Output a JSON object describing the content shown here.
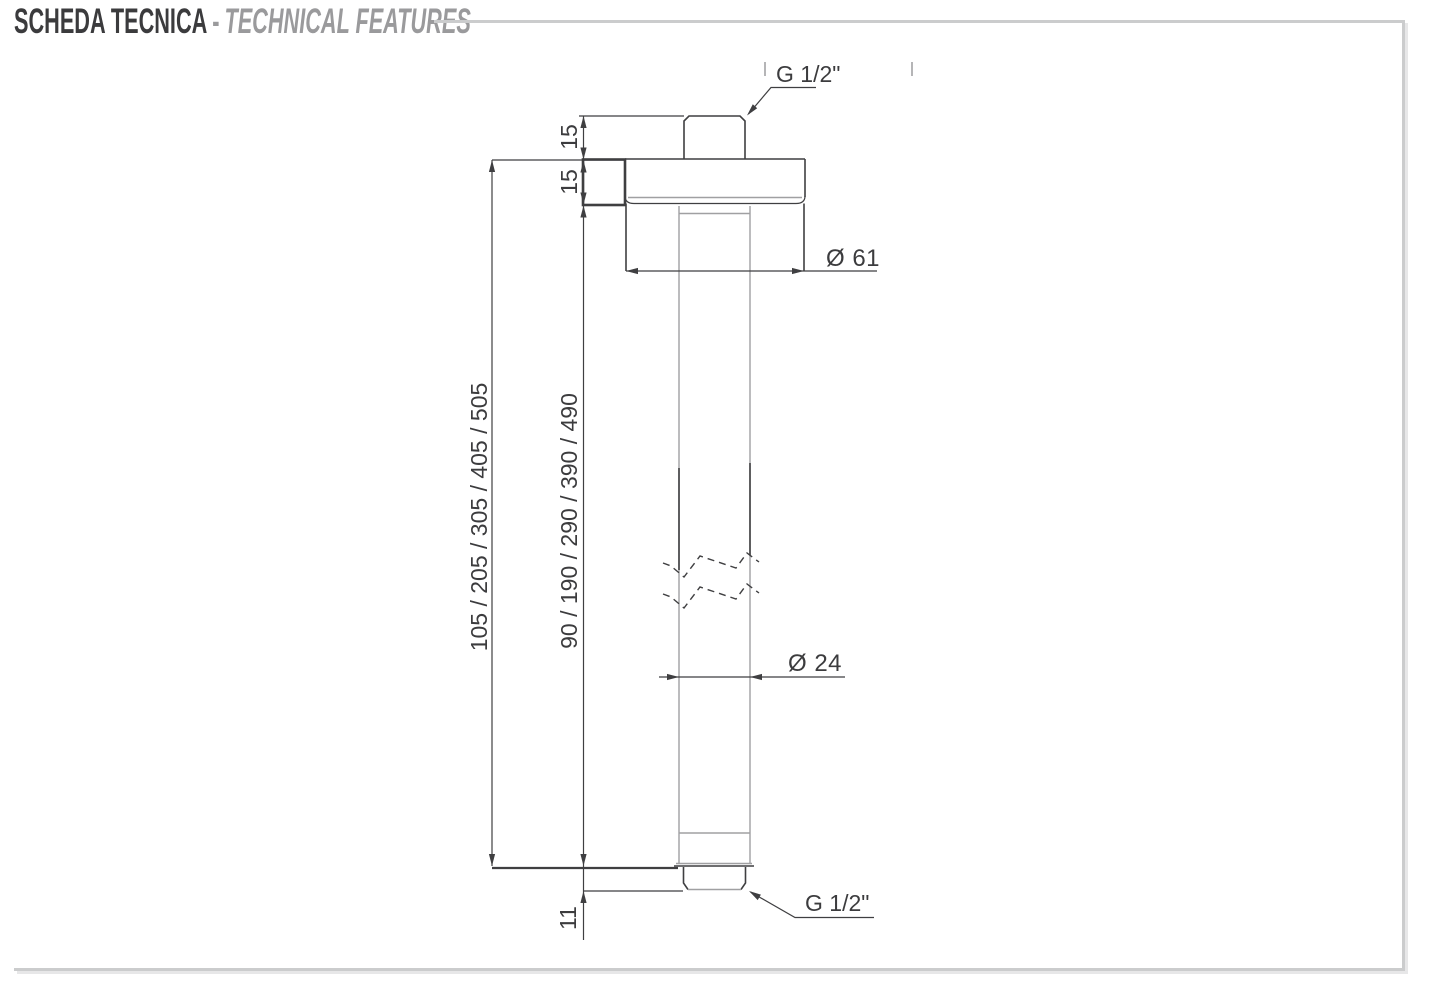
{
  "header": {
    "title_primary": "SCHEDA TECNICA",
    "separator": "-",
    "title_secondary": "TECHNICAL FEATURES"
  },
  "drawing": {
    "dimensions": {
      "top_thread": "G 1/2\"",
      "top_nipple_height": "15",
      "flange_height": "15",
      "flange_diameter": "Ø 61",
      "overall_lengths": "105 / 205 / 305 / 405 / 505",
      "pipe_lengths": "90 / 190 / 290 / 390 / 490",
      "pipe_diameter": "Ø 24",
      "bottom_protrusion": "11",
      "bottom_thread": "G 1/2\""
    },
    "colors": {
      "line_dark": "#3f3f41",
      "line_gray": "#a0a0a2",
      "frame_gray": "#cbcccd",
      "title_dark": "#3b3b3d",
      "title_gray": "#9a9a9c"
    }
  }
}
